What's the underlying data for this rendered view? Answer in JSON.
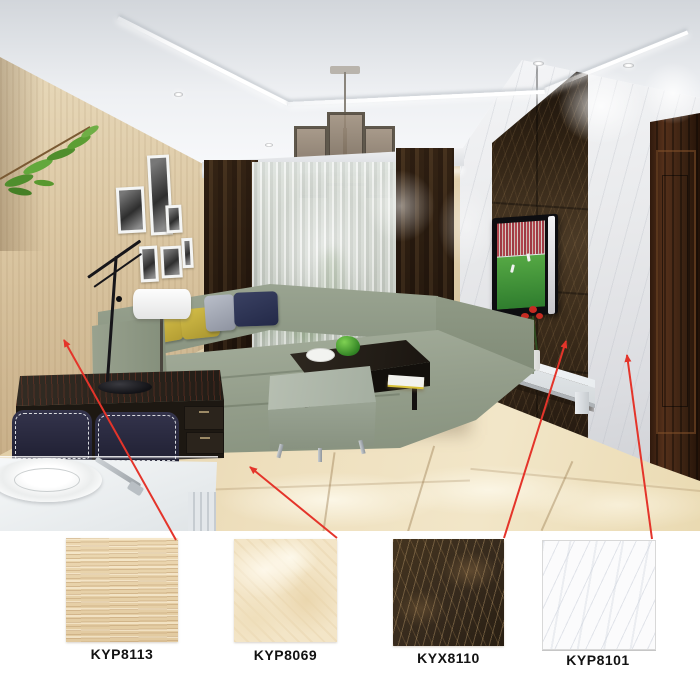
{
  "products": [
    {
      "code": "KYP8113",
      "swatch": "beige-striped-tile-swatch",
      "swatch_color": "#ecd8b2",
      "points_to": "left-wall"
    },
    {
      "code": "KYP8069",
      "swatch": "beige-marble-tile-swatch",
      "swatch_color": "#f3e5c7",
      "points_to": "floor"
    },
    {
      "code": "KYX8110",
      "swatch": "dark-brown-marble-tile-swatch",
      "swatch_color": "#362a1d",
      "points_to": "tv-feature-wall"
    },
    {
      "code": "KYP8101",
      "swatch": "white-marble-tile-swatch",
      "swatch_color": "#fbfbfc",
      "points_to": "right-wall"
    }
  ],
  "colors": {
    "arrow": "#e4342a",
    "background": "#ffffff",
    "label_text": "#121212",
    "wall_left_beige": "#dcc8a4",
    "floor_beige": "#eedfbd",
    "feature_wall_brown": "#3a2b1a",
    "right_wall_white": "#e9eaec",
    "door_brown": "#3a2212",
    "sofa_green": "#939d8a",
    "curtain_brown": "#46321e",
    "ceiling_white": "#eef0f3",
    "pillow_yellow": "#b39d33",
    "pillow_navy": "#232948",
    "tv_screen_green": "#2f7d2e",
    "ottoman_green": "#a4aea0",
    "counter_white": "#e6eaec"
  },
  "scene": {
    "name": "living-room-render",
    "objects": [
      "ceiling-cove",
      "downlights",
      "chandelier",
      "plant-branch",
      "photo-frames",
      "left-tiled-wall",
      "curtains",
      "sheer-window",
      "sofa",
      "pillows",
      "table-lamps",
      "console-table",
      "coffee-table",
      "ottoman",
      "floor-tiles",
      "tv",
      "tv-feature-wall",
      "tv-shelf",
      "flower-vase",
      "right-marble-wall",
      "wood-door",
      "dining-counter",
      "plate",
      "fork",
      "chairs"
    ]
  }
}
